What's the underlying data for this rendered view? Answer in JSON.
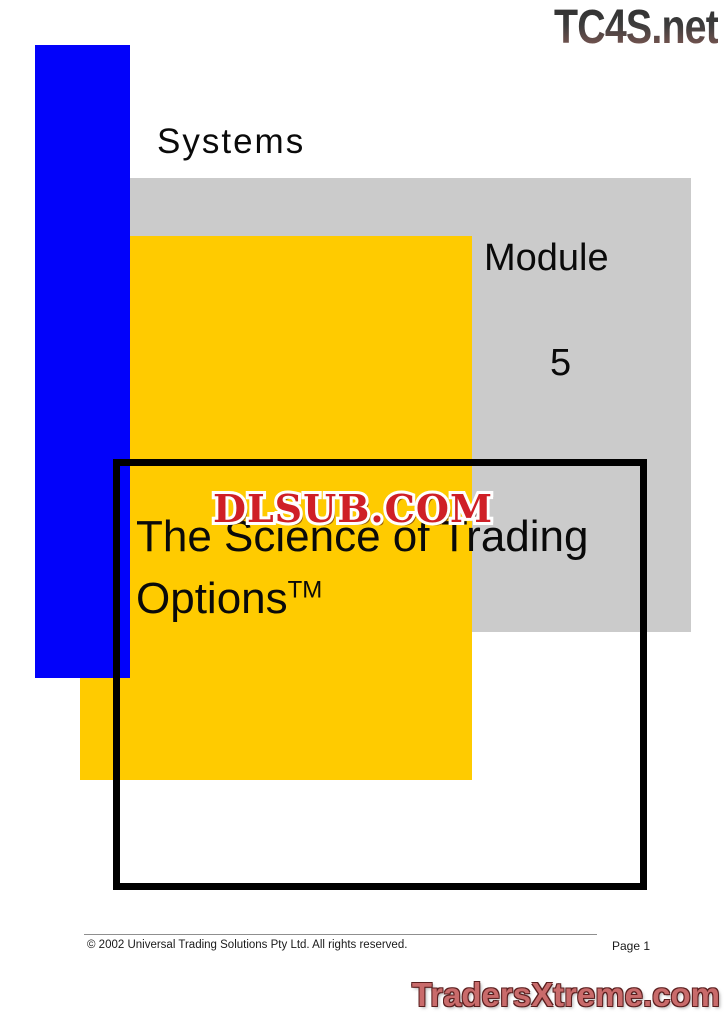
{
  "colors": {
    "blue": "#0202fa",
    "yellow": "#ffcb00",
    "gray": "#cbcbcb",
    "box-border": "#000000",
    "dlsub-red": "#cf1f26",
    "dlsub-outline": "#ffffff",
    "tx-red": "#c96b6b",
    "tx-outline": "#5a1f1f",
    "tc4s-top": "#2d2d2d",
    "tc4s-bottom": "#8f5f59"
  },
  "watermarks": {
    "top_right": "TC4S.net",
    "center": "DLSUB.COM",
    "bottom_right": "TradersXtreme.com"
  },
  "cover": {
    "systems_label": "Systems",
    "module_label": "Module",
    "module_number": "5",
    "title_line1": "The Science of Trading",
    "title_line2": "Options",
    "trademark": "TM"
  },
  "footer": {
    "copyright": "© 2002 Universal Trading Solutions Pty Ltd. All rights reserved.",
    "page_label": "Page 1"
  }
}
